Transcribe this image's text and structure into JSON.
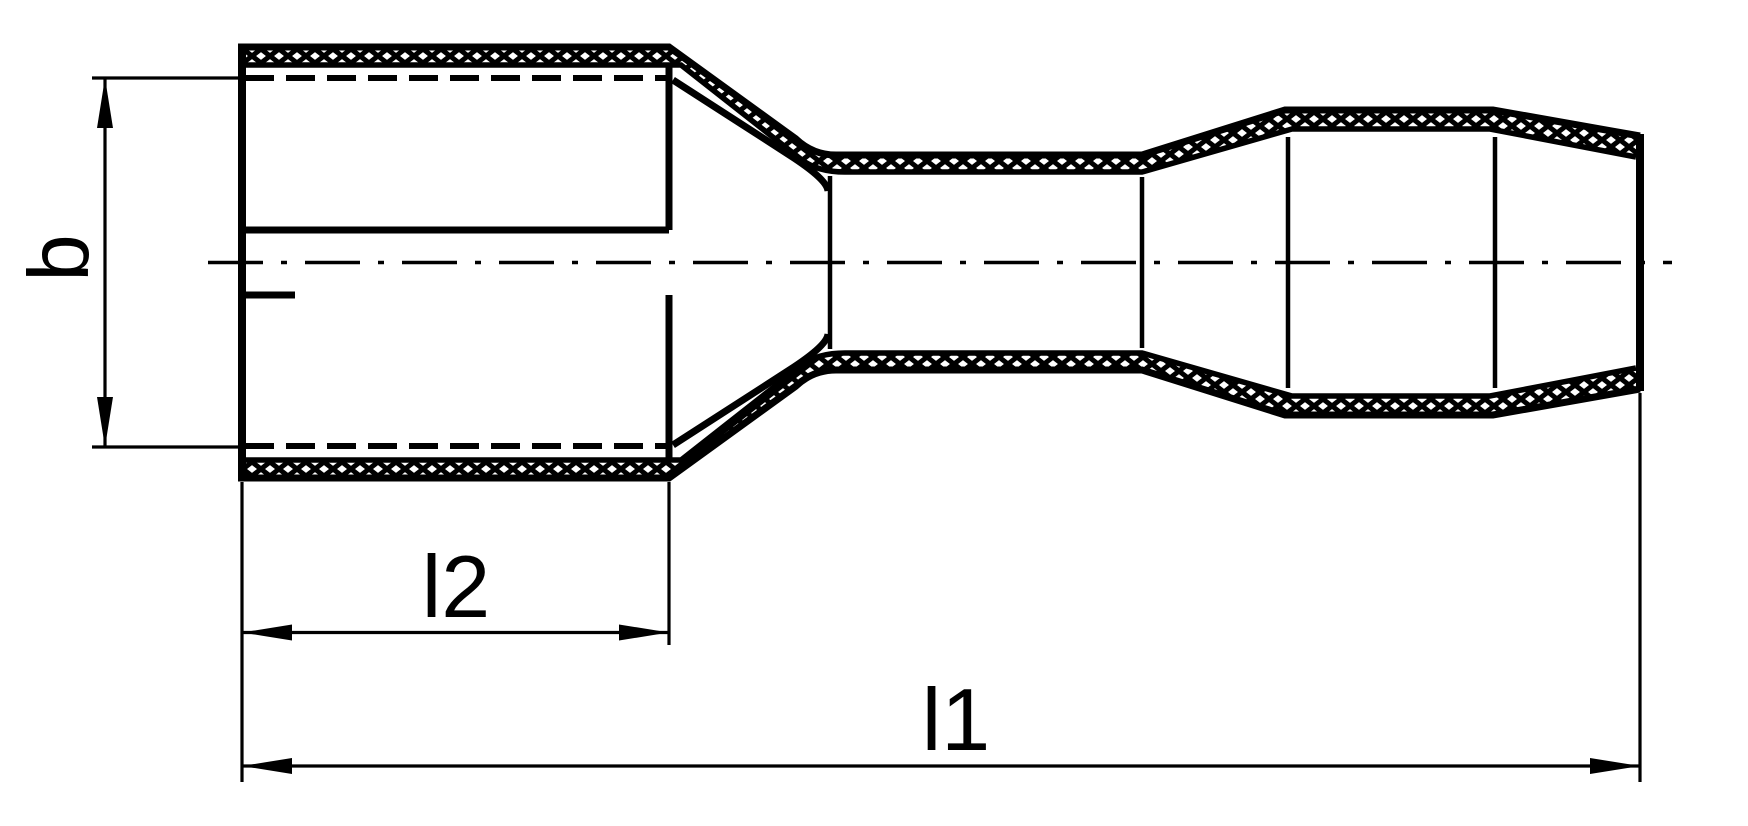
{
  "drawing": {
    "labels": {
      "width": "b",
      "contact_length": "l2",
      "overall_length": "l1"
    },
    "colors": {
      "ink": "#000000",
      "paper": "#ffffff"
    }
  }
}
